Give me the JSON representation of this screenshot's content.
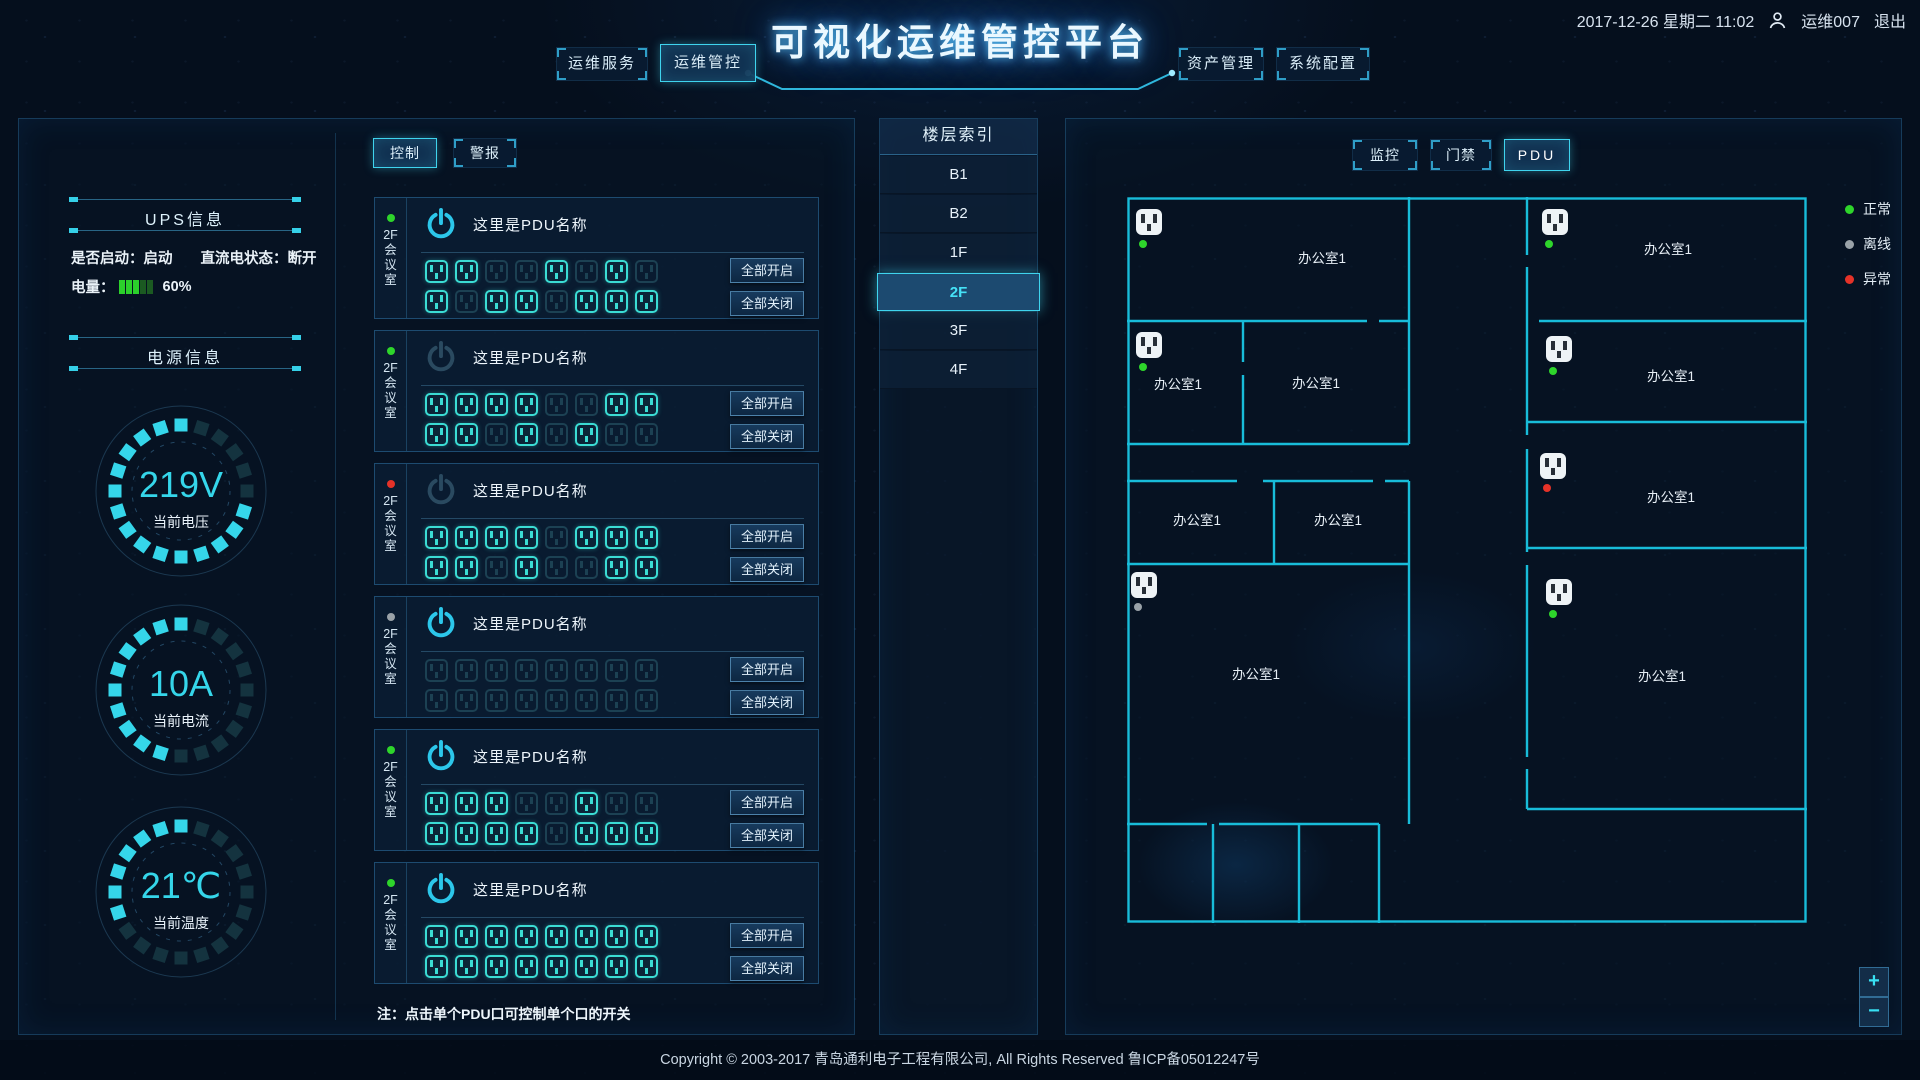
{
  "header": {
    "title": "可视化运维管控平台",
    "datetime": "2017-12-26 星期二 11:02",
    "user": "运维007",
    "logout": "退出",
    "nav": [
      {
        "label": "运维服务",
        "active": false
      },
      {
        "label": "运维管控",
        "active": true
      },
      {
        "label": "资产管理",
        "active": false
      },
      {
        "label": "系统配置",
        "active": false
      }
    ]
  },
  "ups": {
    "title": "UPS信息",
    "start_text": "是否启动：启动",
    "dc_text": "直流电状态：断开",
    "battery_label": "电量：",
    "battery_percent": "60%",
    "battery_segments": [
      1,
      1,
      1,
      0,
      0
    ],
    "battery_on_color": "#2bd02b",
    "battery_off_color": "#1b5a22"
  },
  "power": {
    "title": "电源信息",
    "gauges": [
      {
        "value": "219V",
        "label": "当前电压",
        "filled": 15,
        "total": 20
      },
      {
        "value": "10A",
        "label": "当前电流",
        "filled": 10,
        "total": 20
      },
      {
        "value": "21℃",
        "label": "当前温度",
        "filled": 7,
        "total": 20
      }
    ],
    "segment_on": "#35d6ea",
    "segment_off": "#14333f"
  },
  "control": {
    "tabs": [
      {
        "label": "控制",
        "active": true
      },
      {
        "label": "警报",
        "active": false
      }
    ],
    "on_all": "全部开启",
    "off_all": "全部关闭",
    "note": "注：点击单个PDU口可控制单个口的开关",
    "pdus": [
      {
        "room": "2F会议室",
        "name": "这里是PDU名称",
        "status": "green",
        "power_bright": true,
        "outlets": [
          1,
          1,
          0,
          0,
          1,
          0,
          1,
          0,
          1,
          0,
          1,
          1,
          0,
          1,
          1,
          1
        ]
      },
      {
        "room": "2F会议室",
        "name": "这里是PDU名称",
        "status": "green",
        "power_bright": false,
        "outlets": [
          1,
          1,
          1,
          1,
          0,
          0,
          1,
          1,
          1,
          1,
          0,
          1,
          0,
          1,
          0,
          0
        ]
      },
      {
        "room": "2F会议室",
        "name": "这里是PDU名称",
        "status": "red",
        "power_bright": false,
        "outlets": [
          1,
          1,
          1,
          1,
          0,
          1,
          1,
          1,
          1,
          1,
          0,
          1,
          0,
          0,
          1,
          1
        ]
      },
      {
        "room": "2F会议室",
        "name": "这里是PDU名称",
        "status": "gray",
        "power_bright": true,
        "outlets": [
          0,
          0,
          0,
          0,
          0,
          0,
          0,
          0,
          0,
          0,
          0,
          0,
          0,
          0,
          0,
          0
        ]
      },
      {
        "room": "2F会议室",
        "name": "这里是PDU名称",
        "status": "green",
        "power_bright": true,
        "outlets": [
          1,
          1,
          1,
          0,
          0,
          1,
          0,
          0,
          1,
          1,
          1,
          1,
          0,
          1,
          1,
          1
        ]
      },
      {
        "room": "2F会议室",
        "name": "这里是PDU名称",
        "status": "green",
        "power_bright": true,
        "outlets": [
          1,
          1,
          1,
          1,
          1,
          1,
          1,
          1,
          1,
          1,
          1,
          1,
          1,
          1,
          1,
          1
        ]
      }
    ]
  },
  "floors": {
    "title": "楼层索引",
    "items": [
      "B1",
      "B2",
      "1F",
      "2F",
      "3F",
      "4F"
    ],
    "selected": "2F"
  },
  "plan": {
    "tabs": [
      {
        "label": "监控",
        "active": false
      },
      {
        "label": "门禁",
        "active": false
      },
      {
        "label": "PDU",
        "active": true
      }
    ],
    "legend": [
      {
        "label": "正常",
        "color": "#2ed52b"
      },
      {
        "label": "离线",
        "color": "#9aa2a8"
      },
      {
        "label": "异常",
        "color": "#e53228"
      }
    ],
    "rooms": [
      {
        "label": "办公室1",
        "x": 195,
        "y": 60
      },
      {
        "label": "办公室1",
        "x": 51,
        "y": 186
      },
      {
        "label": "办公室1",
        "x": 189,
        "y": 185
      },
      {
        "label": "办公室1",
        "x": 70,
        "y": 322
      },
      {
        "label": "办公室1",
        "x": 211,
        "y": 322
      },
      {
        "label": "办公室1",
        "x": 129,
        "y": 476
      },
      {
        "label": "办公室1",
        "x": 541,
        "y": 51
      },
      {
        "label": "办公室1",
        "x": 544,
        "y": 178
      },
      {
        "label": "办公室1",
        "x": 544,
        "y": 299
      },
      {
        "label": "办公室1",
        "x": 535,
        "y": 478
      }
    ],
    "sockets": [
      {
        "x": 22,
        "y": 25,
        "status": "green"
      },
      {
        "x": 22,
        "y": 148,
        "status": "green"
      },
      {
        "x": 17,
        "y": 388,
        "status": "gray"
      },
      {
        "x": 428,
        "y": 25,
        "status": "green"
      },
      {
        "x": 432,
        "y": 152,
        "status": "green"
      },
      {
        "x": 426,
        "y": 269,
        "status": "red"
      },
      {
        "x": 432,
        "y": 395,
        "status": "green"
      }
    ],
    "zoom_in": "+",
    "zoom_out": "−"
  },
  "status_colors": {
    "green": "#2ed52b",
    "gray": "#9aa2a8",
    "red": "#e53228"
  },
  "footer": {
    "copyright": "Copyright © 2003-2017 青岛通利电子工程有限公司, All Rights Reserved   鲁ICP备05012247号"
  }
}
